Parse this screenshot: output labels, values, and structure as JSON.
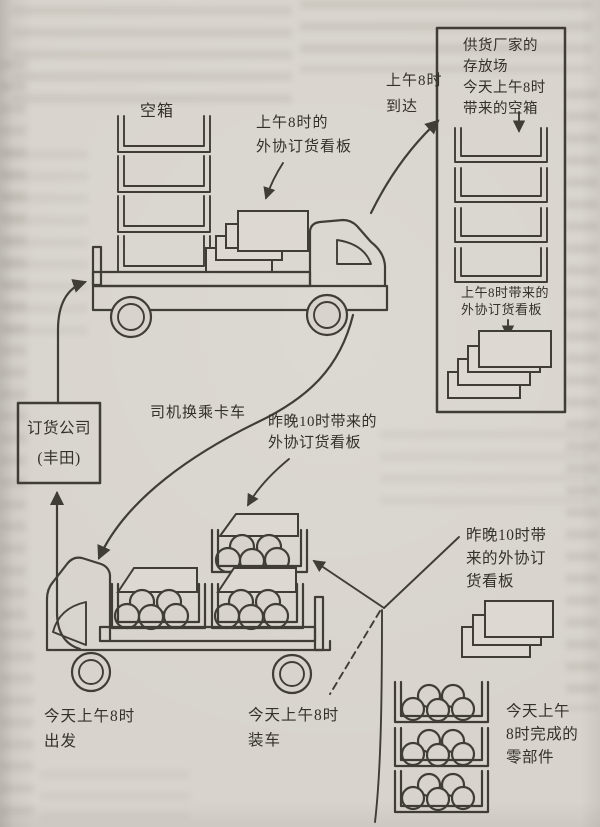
{
  "page": {
    "paper_color": "#d8d4cd",
    "paper_light_color": "#ddd9d2",
    "ink_color": "#403c36",
    "text_color": "#34302a"
  },
  "labels": {
    "empty_boxes": "空箱",
    "kanban_8am": "上午8时的\n外协订货看板",
    "arrive_8am": "上午8时\n到达",
    "supplier_storage": "供货厂家的\n存放场\n今天上午8时\n带来的空箱",
    "kanban_brought_8am": "上午8时带来的\n外协订货看板",
    "ordering_company": "订货公司\n(丰田)",
    "driver_switch": "司机换乘卡车",
    "kanban_10pm": "昨晚10时带来的\n外协订货看板",
    "kanban_10pm_right": "昨晚10时带\n来的外协订\n货看板",
    "depart_8am": "今天上午8时\n出发",
    "load_8am": "今天上午8时\n装车",
    "parts_done_8am": "今天上午\n8时完成的\n零部件"
  }
}
